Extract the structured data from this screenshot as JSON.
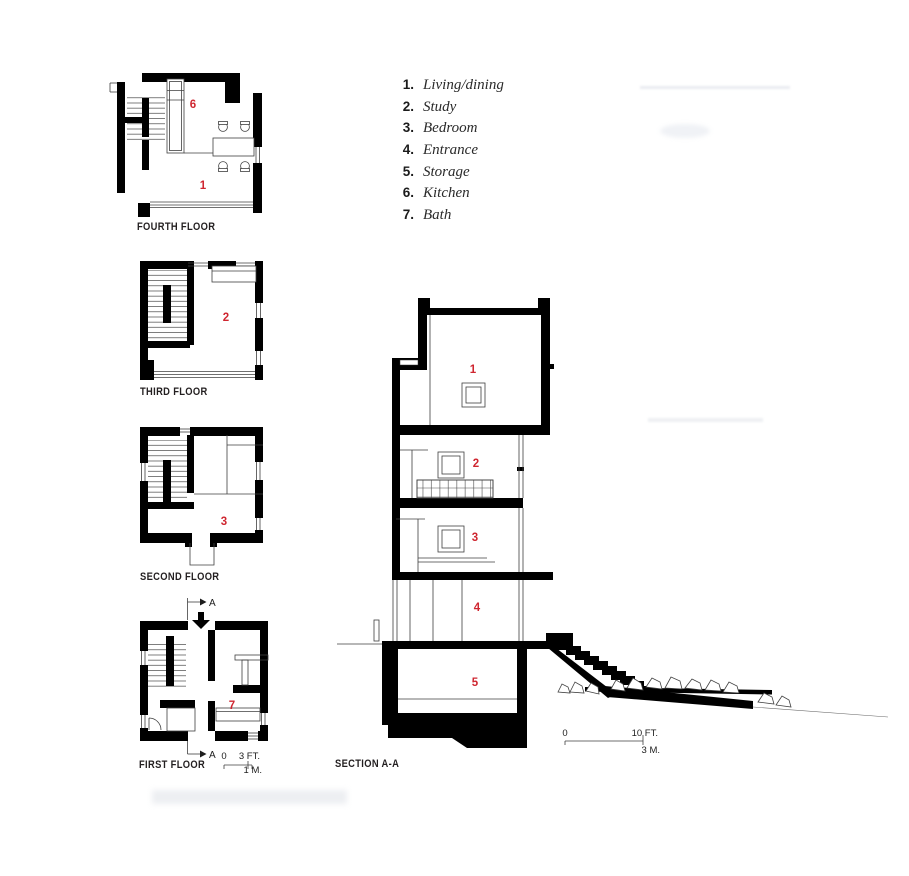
{
  "colors": {
    "accent_red": "#cf2630",
    "ink": "#000000",
    "thin_line": "#3f3f3f"
  },
  "legend": {
    "items": [
      {
        "num": "1.",
        "label": "Living/dining"
      },
      {
        "num": "2.",
        "label": "Study"
      },
      {
        "num": "3.",
        "label": "Bedroom"
      },
      {
        "num": "4.",
        "label": "Entrance"
      },
      {
        "num": "5.",
        "label": "Storage"
      },
      {
        "num": "6.",
        "label": "Kitchen"
      },
      {
        "num": "7.",
        "label": "Bath"
      }
    ]
  },
  "plans": {
    "fourth": {
      "label": "FOURTH FLOOR",
      "rooms": [
        {
          "n": "6"
        },
        {
          "n": "1"
        }
      ]
    },
    "third": {
      "label": "THIRD FLOOR",
      "rooms": [
        {
          "n": "2"
        }
      ]
    },
    "second": {
      "label": "SECOND FLOOR",
      "rooms": [
        {
          "n": "3"
        }
      ]
    },
    "first": {
      "label": "FIRST FLOOR",
      "rooms": [
        {
          "n": "7"
        }
      ],
      "cut_top": "A",
      "cut_bottom": "A"
    }
  },
  "section": {
    "label": "SECTION A-A",
    "rooms": [
      {
        "n": "1"
      },
      {
        "n": "2"
      },
      {
        "n": "3"
      },
      {
        "n": "4"
      },
      {
        "n": "5"
      }
    ]
  },
  "scales": {
    "plan": {
      "zero": "0",
      "imperial": "3 FT.",
      "metric": "1 M."
    },
    "section": {
      "zero": "0",
      "imperial": "10 FT.",
      "metric": "3 M."
    }
  }
}
